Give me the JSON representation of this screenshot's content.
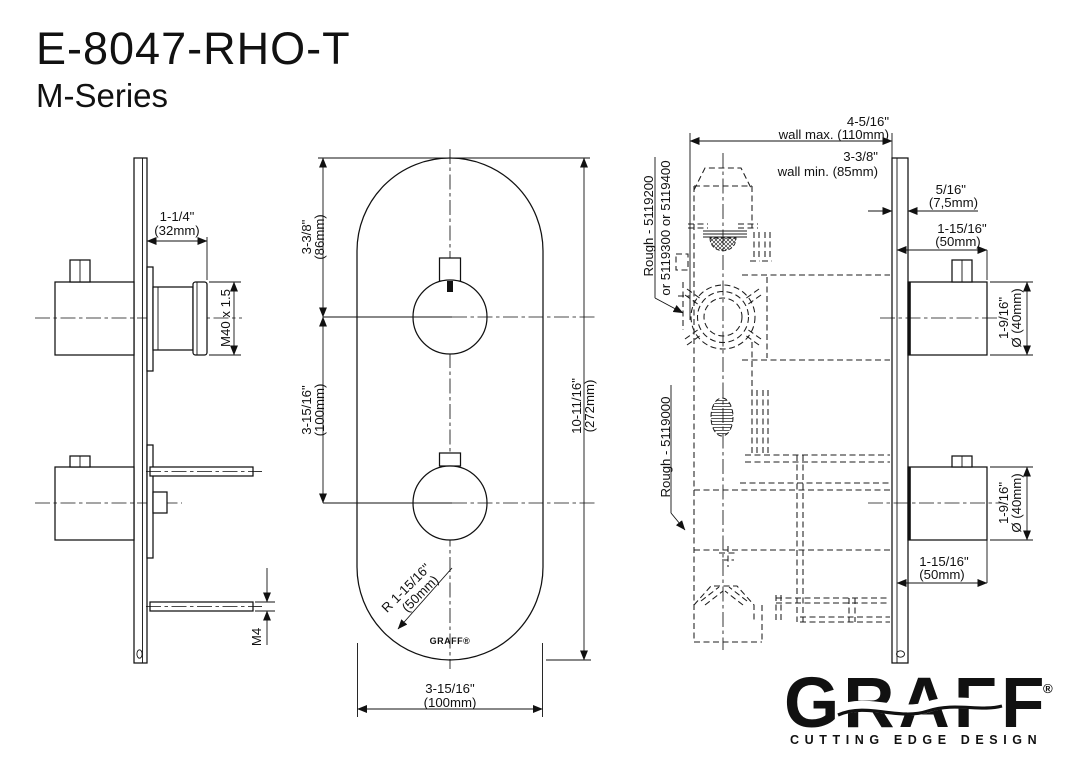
{
  "title": {
    "model": "E-8047-RHO-T",
    "series": "M-Series"
  },
  "side_view": {
    "handle_depth_in": "1-1/4\"",
    "handle_depth_mm": "(32mm)",
    "thread": "M40 x 1.5",
    "screw": "M4"
  },
  "front_view": {
    "top_to_center_in": "3-3/8\"",
    "top_to_center_mm": "(86mm)",
    "center_to_center_in": "3-15/16\"",
    "center_to_center_mm": "(100mm)",
    "height_in": "10-11/16\"",
    "height_mm": "(272mm)",
    "radius_in": "R 1-15/16\"",
    "radius_mm": "(50mm)",
    "width_in": "3-15/16\"",
    "width_mm": "(100mm)",
    "plate_logo": "GRAFF®"
  },
  "section_view": {
    "wall_max_in": "4-5/16\"",
    "wall_max": "wall max. (110mm)",
    "wall_min_in": "3-3/8\"",
    "wall_min": "wall min. (85mm)",
    "plate_thk_in": "5/16\"",
    "plate_thk_mm": "(7,5mm)",
    "handle1_len_in": "1-15/16\"",
    "handle1_len_mm": "(50mm)",
    "handle1_dia_in": "1-9/16\"",
    "handle1_dia_mm": "Ø (40mm)",
    "handle2_dia_in": "1-9/16\"",
    "handle2_dia_mm": "Ø (40mm)",
    "handle2_len_in": "1-15/16\"",
    "handle2_len_mm": "(50mm)",
    "rough_thermostat_line1": "Rough - 5119200",
    "rough_thermostat_line2": "or 5119300 or 5119400",
    "rough_volume": "Rough - 5119000"
  },
  "brand": {
    "name": "GRAFF",
    "reg": "®",
    "tagline": "CUTTING EDGE DESIGN"
  },
  "colors": {
    "ink": "#111111",
    "background": "#ffffff"
  }
}
